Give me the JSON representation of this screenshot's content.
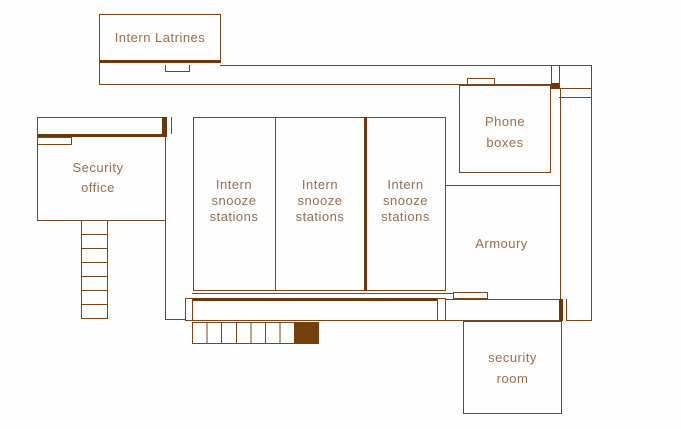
{
  "palette": {
    "wall_line": "#7b4419",
    "wall_thick": "#6b380e",
    "label_text": "#9c6c4c",
    "stair_fill": "#74400e",
    "background": "#ffffff"
  },
  "rooms": {
    "intern_latrines": {
      "label": "Intern Latrines"
    },
    "security_office": {
      "label": "Security\noffice"
    },
    "snooze_station_1": {
      "label": "Intern\nsnooze\nstations"
    },
    "snooze_station_2": {
      "label": "Intern\nsnooze\nstations"
    },
    "snooze_station_3": {
      "label": "Intern\nsnooze\nstations"
    },
    "phone_boxes": {
      "label": "Phone\nboxes"
    },
    "armoury": {
      "label": "Armoury"
    },
    "security_room": {
      "label": "security\nroom"
    }
  }
}
